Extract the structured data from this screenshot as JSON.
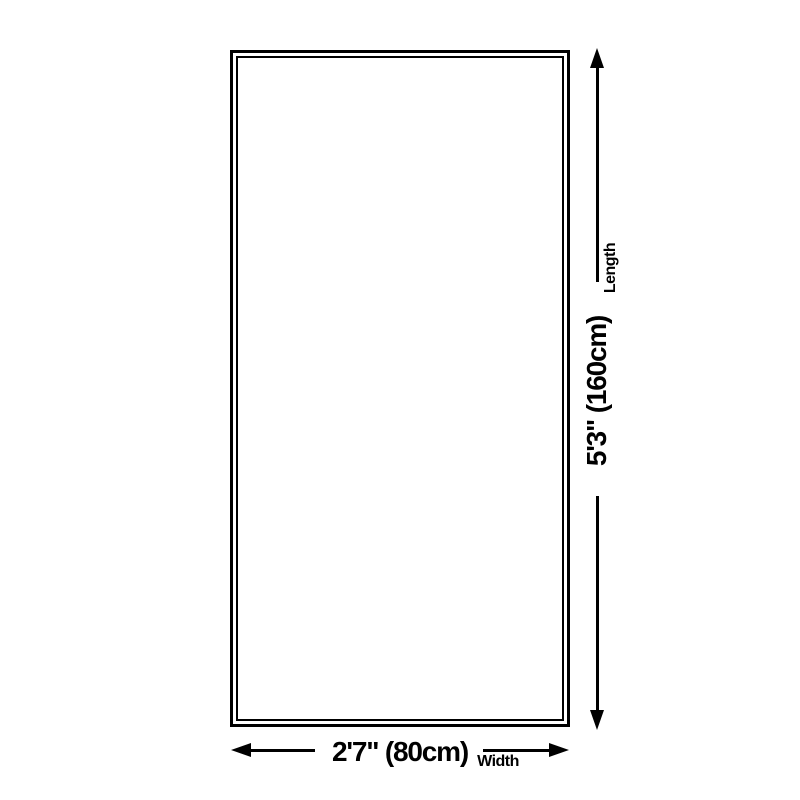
{
  "diagram": {
    "type": "product-size-diagram",
    "background_color": "#ffffff",
    "line_color": "#000000",
    "text_color": "#000000",
    "shape": "rectangle-double-border",
    "dimensions": {
      "length": {
        "value": "5'3\" (160cm)",
        "label": "Length",
        "arrow_orientation": "vertical"
      },
      "width": {
        "value": "2'7\" (80cm)",
        "label": "Width",
        "arrow_orientation": "horizontal"
      }
    }
  }
}
